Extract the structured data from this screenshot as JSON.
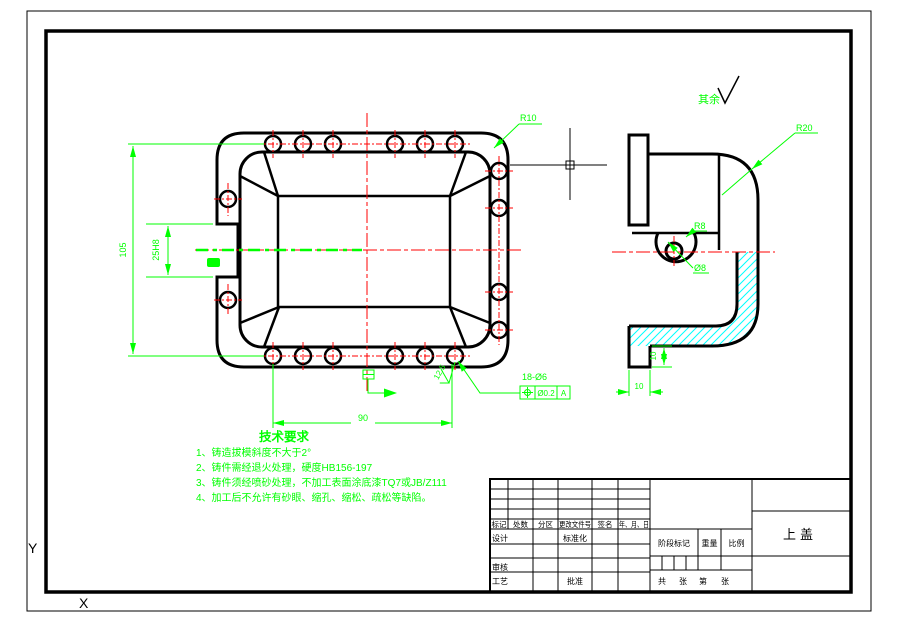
{
  "canvas": {
    "width": 899,
    "height": 630
  },
  "colors": {
    "background": "#FFFFFF",
    "outline": "#000000",
    "dimension": "#00FF00",
    "centerline": "#FF0000",
    "hatch": "#00FFFF"
  },
  "ucs": {
    "x_label": "X",
    "y_label": "Y"
  },
  "surface_note": {
    "text": "其余"
  },
  "plan_view": {
    "dim_height": "105",
    "dim_slot": "25H8",
    "dim_width": "90",
    "fillet_radius": "R10",
    "holes_note": "18-Ø6",
    "tolerance": {
      "symbol": "position",
      "value": "Ø0.2",
      "datum": "A"
    },
    "roughness": "12.5"
  },
  "section_view": {
    "corner_radius": "R20",
    "boss_radius": "R8",
    "hole_dia": "Ø8",
    "tab_height": "10",
    "tab_width": "10"
  },
  "tech_requirements": {
    "heading": "技术要求",
    "items": [
      "1、铸造拔模斜度不大于2°",
      "2、铸件需经退火处理，硬度HB156-197",
      "3、铸件须经喷砂处理，不加工表面涂底漆TQ7或JB/Z111",
      "4、加工后不允许有砂眼、缩孔、缩松、疏松等缺陷。"
    ]
  },
  "title_block": {
    "header": [
      "标记",
      "处数",
      "分区",
      "更改文件号",
      "签名",
      "年、月、日"
    ],
    "design": "设计",
    "standardization": "标准化",
    "check": "审核",
    "process": "工艺",
    "approve": "批准",
    "stage_mark": "阶段标记",
    "weight": "重量",
    "scale": "比例",
    "sheet": [
      "共",
      "张",
      "第",
      "张"
    ],
    "part_name": "上盖"
  }
}
